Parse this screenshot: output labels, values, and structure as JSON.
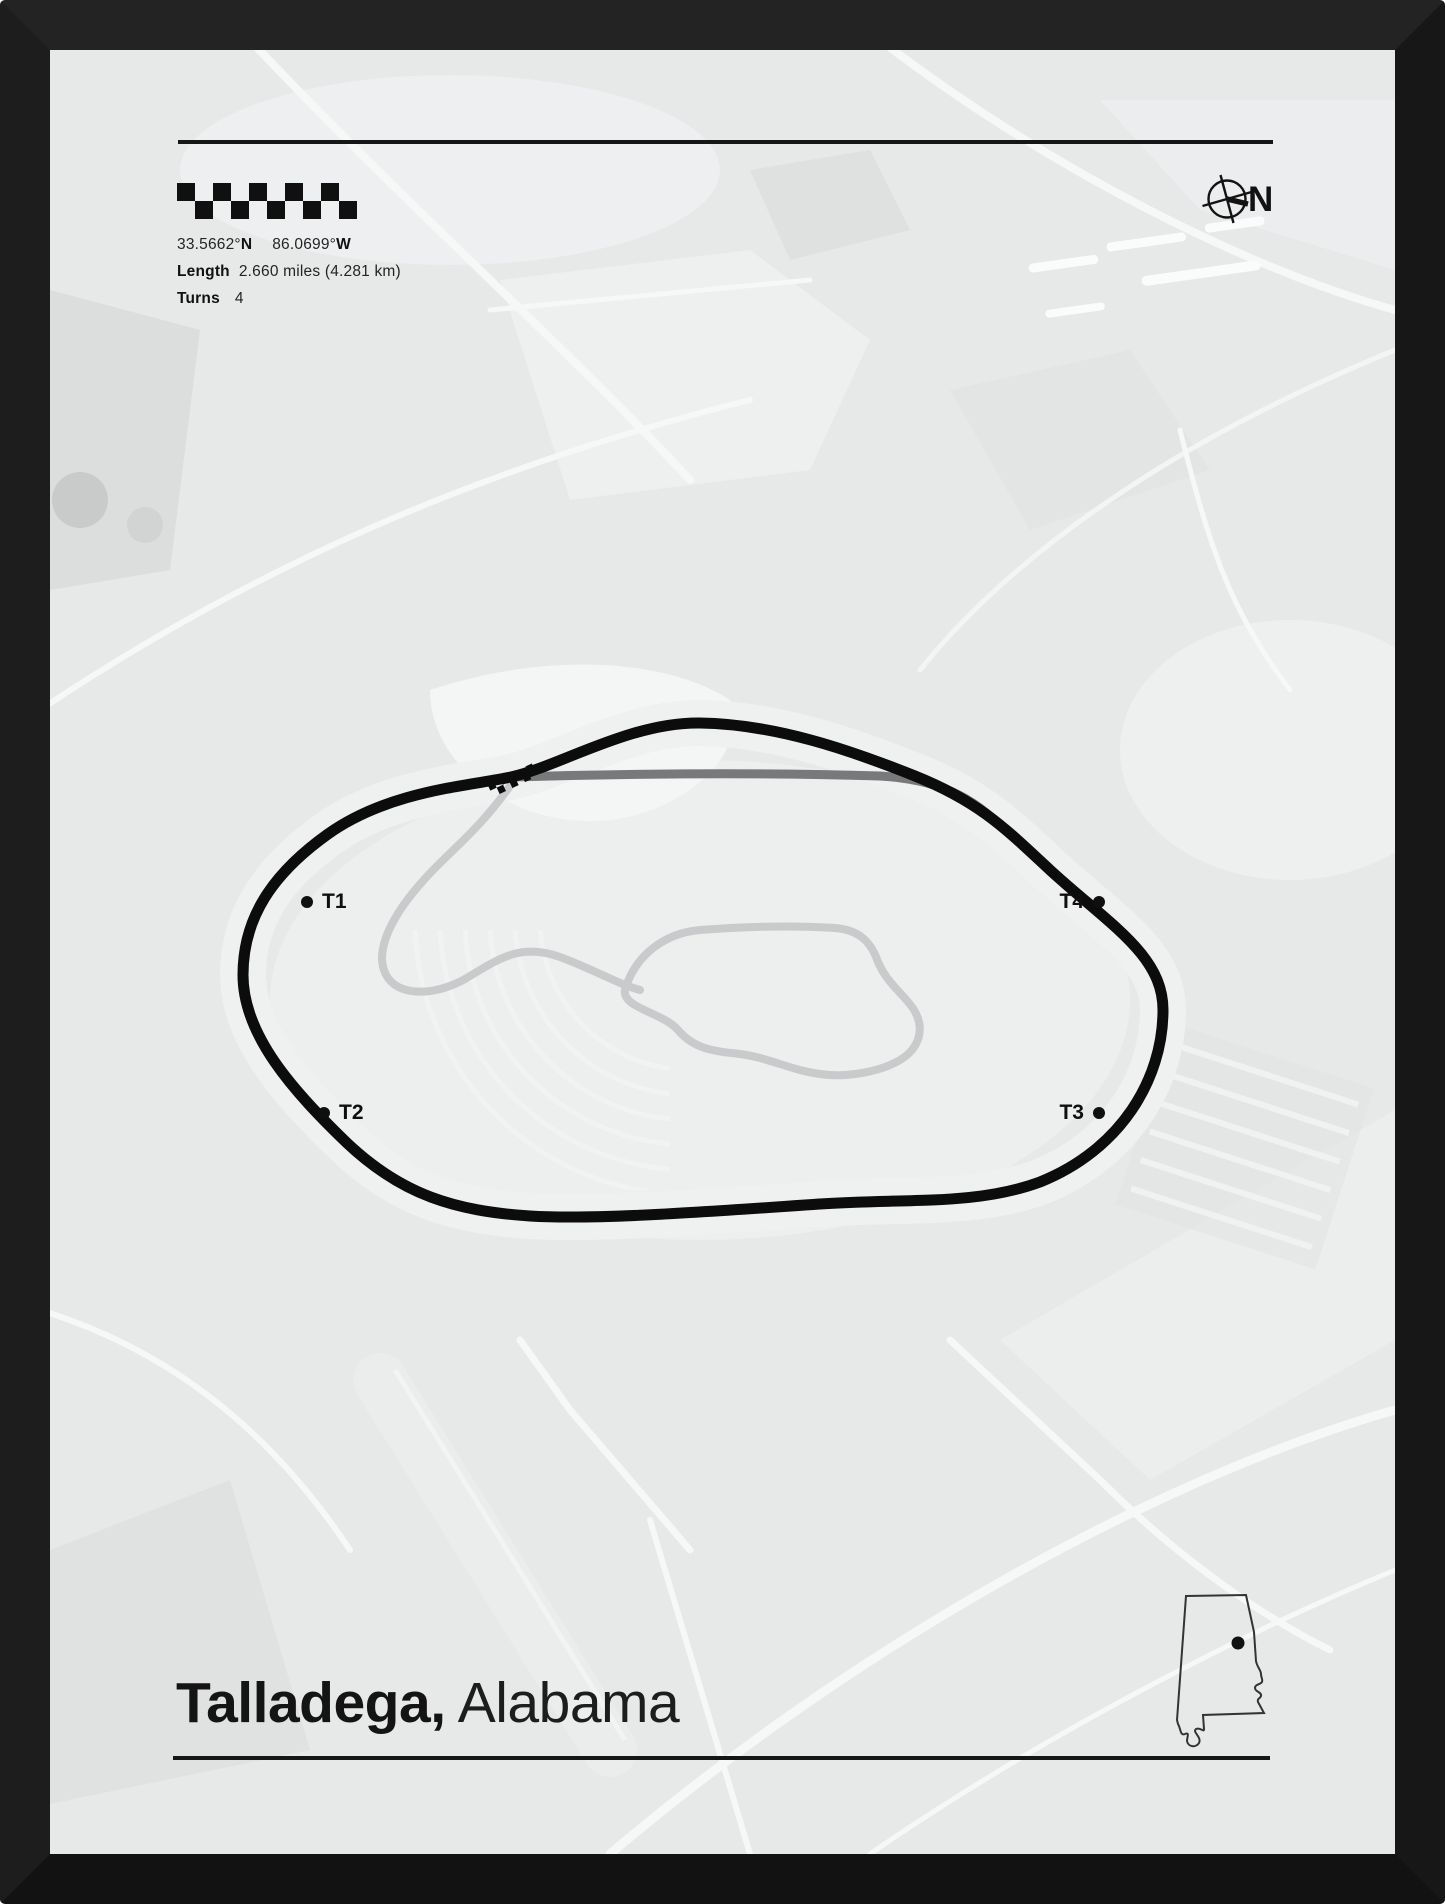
{
  "poster": {
    "stats": {
      "lat_value": "33.5662°",
      "lat_dir": "N",
      "lon_value": "86.0699°",
      "lon_dir": "W",
      "length_label": "Length",
      "length_value": "2.660 miles (4.281 km)",
      "turns_label": "Turns",
      "turns_value": "4"
    },
    "compass": {
      "label": "N"
    },
    "turn_markers": [
      {
        "label": "T1"
      },
      {
        "label": "T2"
      },
      {
        "label": "T3"
      },
      {
        "label": "T4"
      }
    ],
    "title": {
      "main": "Talladega,",
      "rest": " Alabama"
    },
    "icons": {
      "flag": "checkered-flag-icon",
      "compass": "compass-rose-icon",
      "start_finish": "start-finish-checker-icon",
      "state_outline": "alabama-state-outline-icon"
    },
    "colors": {
      "frame": "#181818",
      "paper": "#e7e8e8",
      "track": "#0c0c0c",
      "pit_lane": "#77797a",
      "service_roads": "#c8cacb",
      "ink": "#141414"
    }
  }
}
